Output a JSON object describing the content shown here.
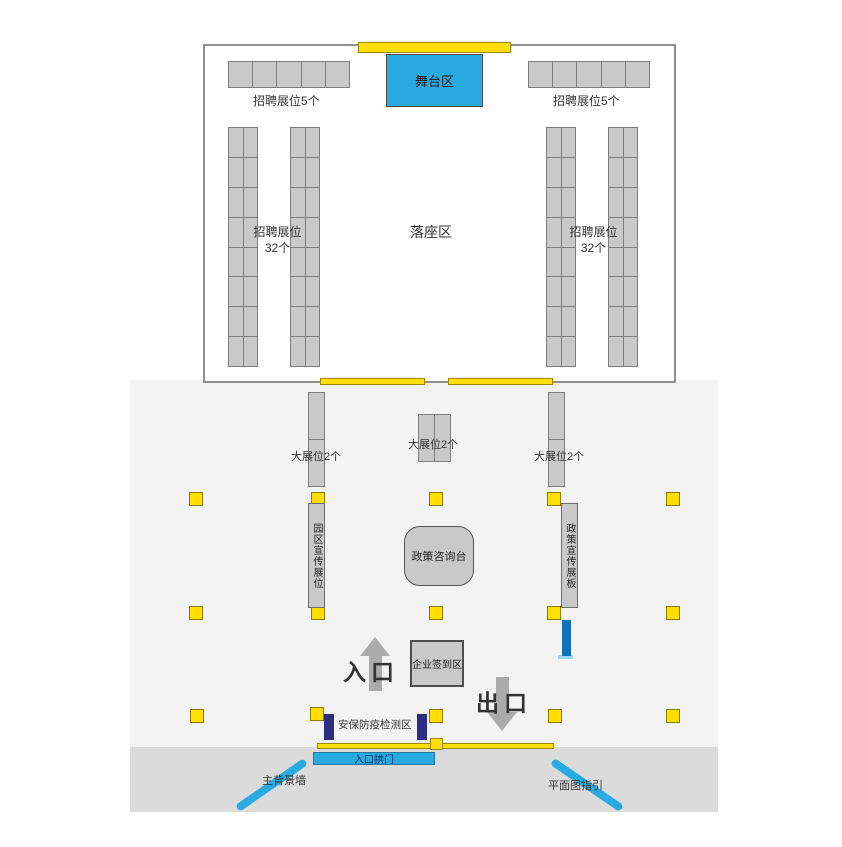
{
  "hall": {
    "stage_label": "舞台区",
    "booths_top_left_label": "招聘展位5个",
    "booths_top_right_label": "招聘展位5个",
    "columns_label_line1": "招聘展位",
    "columns_label_line2": "32个",
    "seating_label": "落座区"
  },
  "plaza": {
    "large_booth_left_label": "大展位2个",
    "large_booth_center_label": "大展位2个",
    "large_booth_right_label": "大展位2个",
    "park_promo_booth_label": "园区宣传展位",
    "policy_board_label": "政策宣传展板",
    "policy_desk_label": "政策咨询台",
    "signin_label": "企业签到区",
    "entrance_label": "入口",
    "exit_label": "出口",
    "security_check_label": "安保防疫检测区",
    "entrance_arch_label": "入口拱门",
    "background_wall_label": "主背景墙",
    "floorplan_guide_label": "平面图指引"
  },
  "grids": {
    "row5": {
      "rows": 1,
      "cols": 5
    },
    "col32": {
      "rows": 8,
      "cols": 2
    },
    "large_v": {
      "rows": 2,
      "cols": 1
    },
    "large_h": {
      "rows": 1,
      "cols": 2
    }
  },
  "colors": {
    "accent_blue": "#29ABE2",
    "pillar_yellow": "#FFDE00",
    "navy_blue": "#2B2E83",
    "medium_blue": "#0E72B8",
    "booth_gray": "#C9C9C9"
  }
}
